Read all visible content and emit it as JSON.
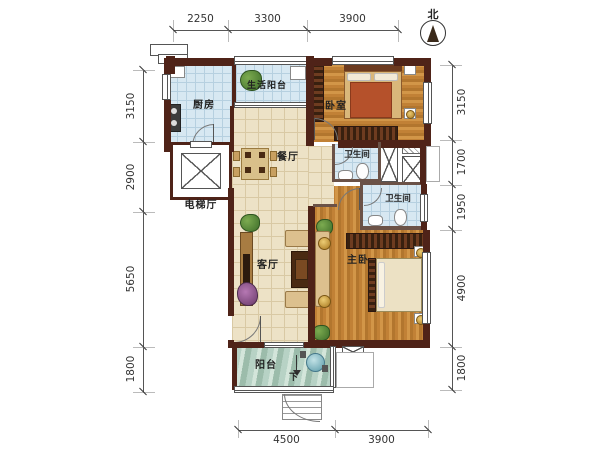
{
  "compass": {
    "label": "北"
  },
  "dimensions": {
    "top": [
      "2250",
      "3300",
      "3900"
    ],
    "left": [
      "3150",
      "2900",
      "5650",
      "1800"
    ],
    "right": [
      "3150",
      "1700",
      "1950",
      "4900",
      "1800"
    ],
    "bottom": [
      "4500",
      "3900"
    ]
  },
  "rooms": {
    "kitchen": {
      "label": "厨房"
    },
    "service_balcony": {
      "label": "生活阳台"
    },
    "bedroom": {
      "label": "卧室"
    },
    "dining": {
      "label": "餐厅"
    },
    "bathroom_1": {
      "label": "卫生间"
    },
    "bathroom_2": {
      "label": "卫生间"
    },
    "elevator_hall": {
      "label": "电梯厅"
    },
    "living": {
      "label": "客厅"
    },
    "master_bedroom": {
      "label": "主卧"
    },
    "balcony": {
      "label": "阳台"
    }
  },
  "annotations": {
    "stairs_down": "下"
  },
  "colors": {
    "wall": "#4f2318",
    "wood_floor": "#c9883c",
    "tile_blue": "#d7e8f2",
    "tile_cream": "#ede2c6",
    "balcony_green": "#b7d2c5",
    "bed_orange": "#b5512b",
    "dimension_text": "#333333"
  }
}
